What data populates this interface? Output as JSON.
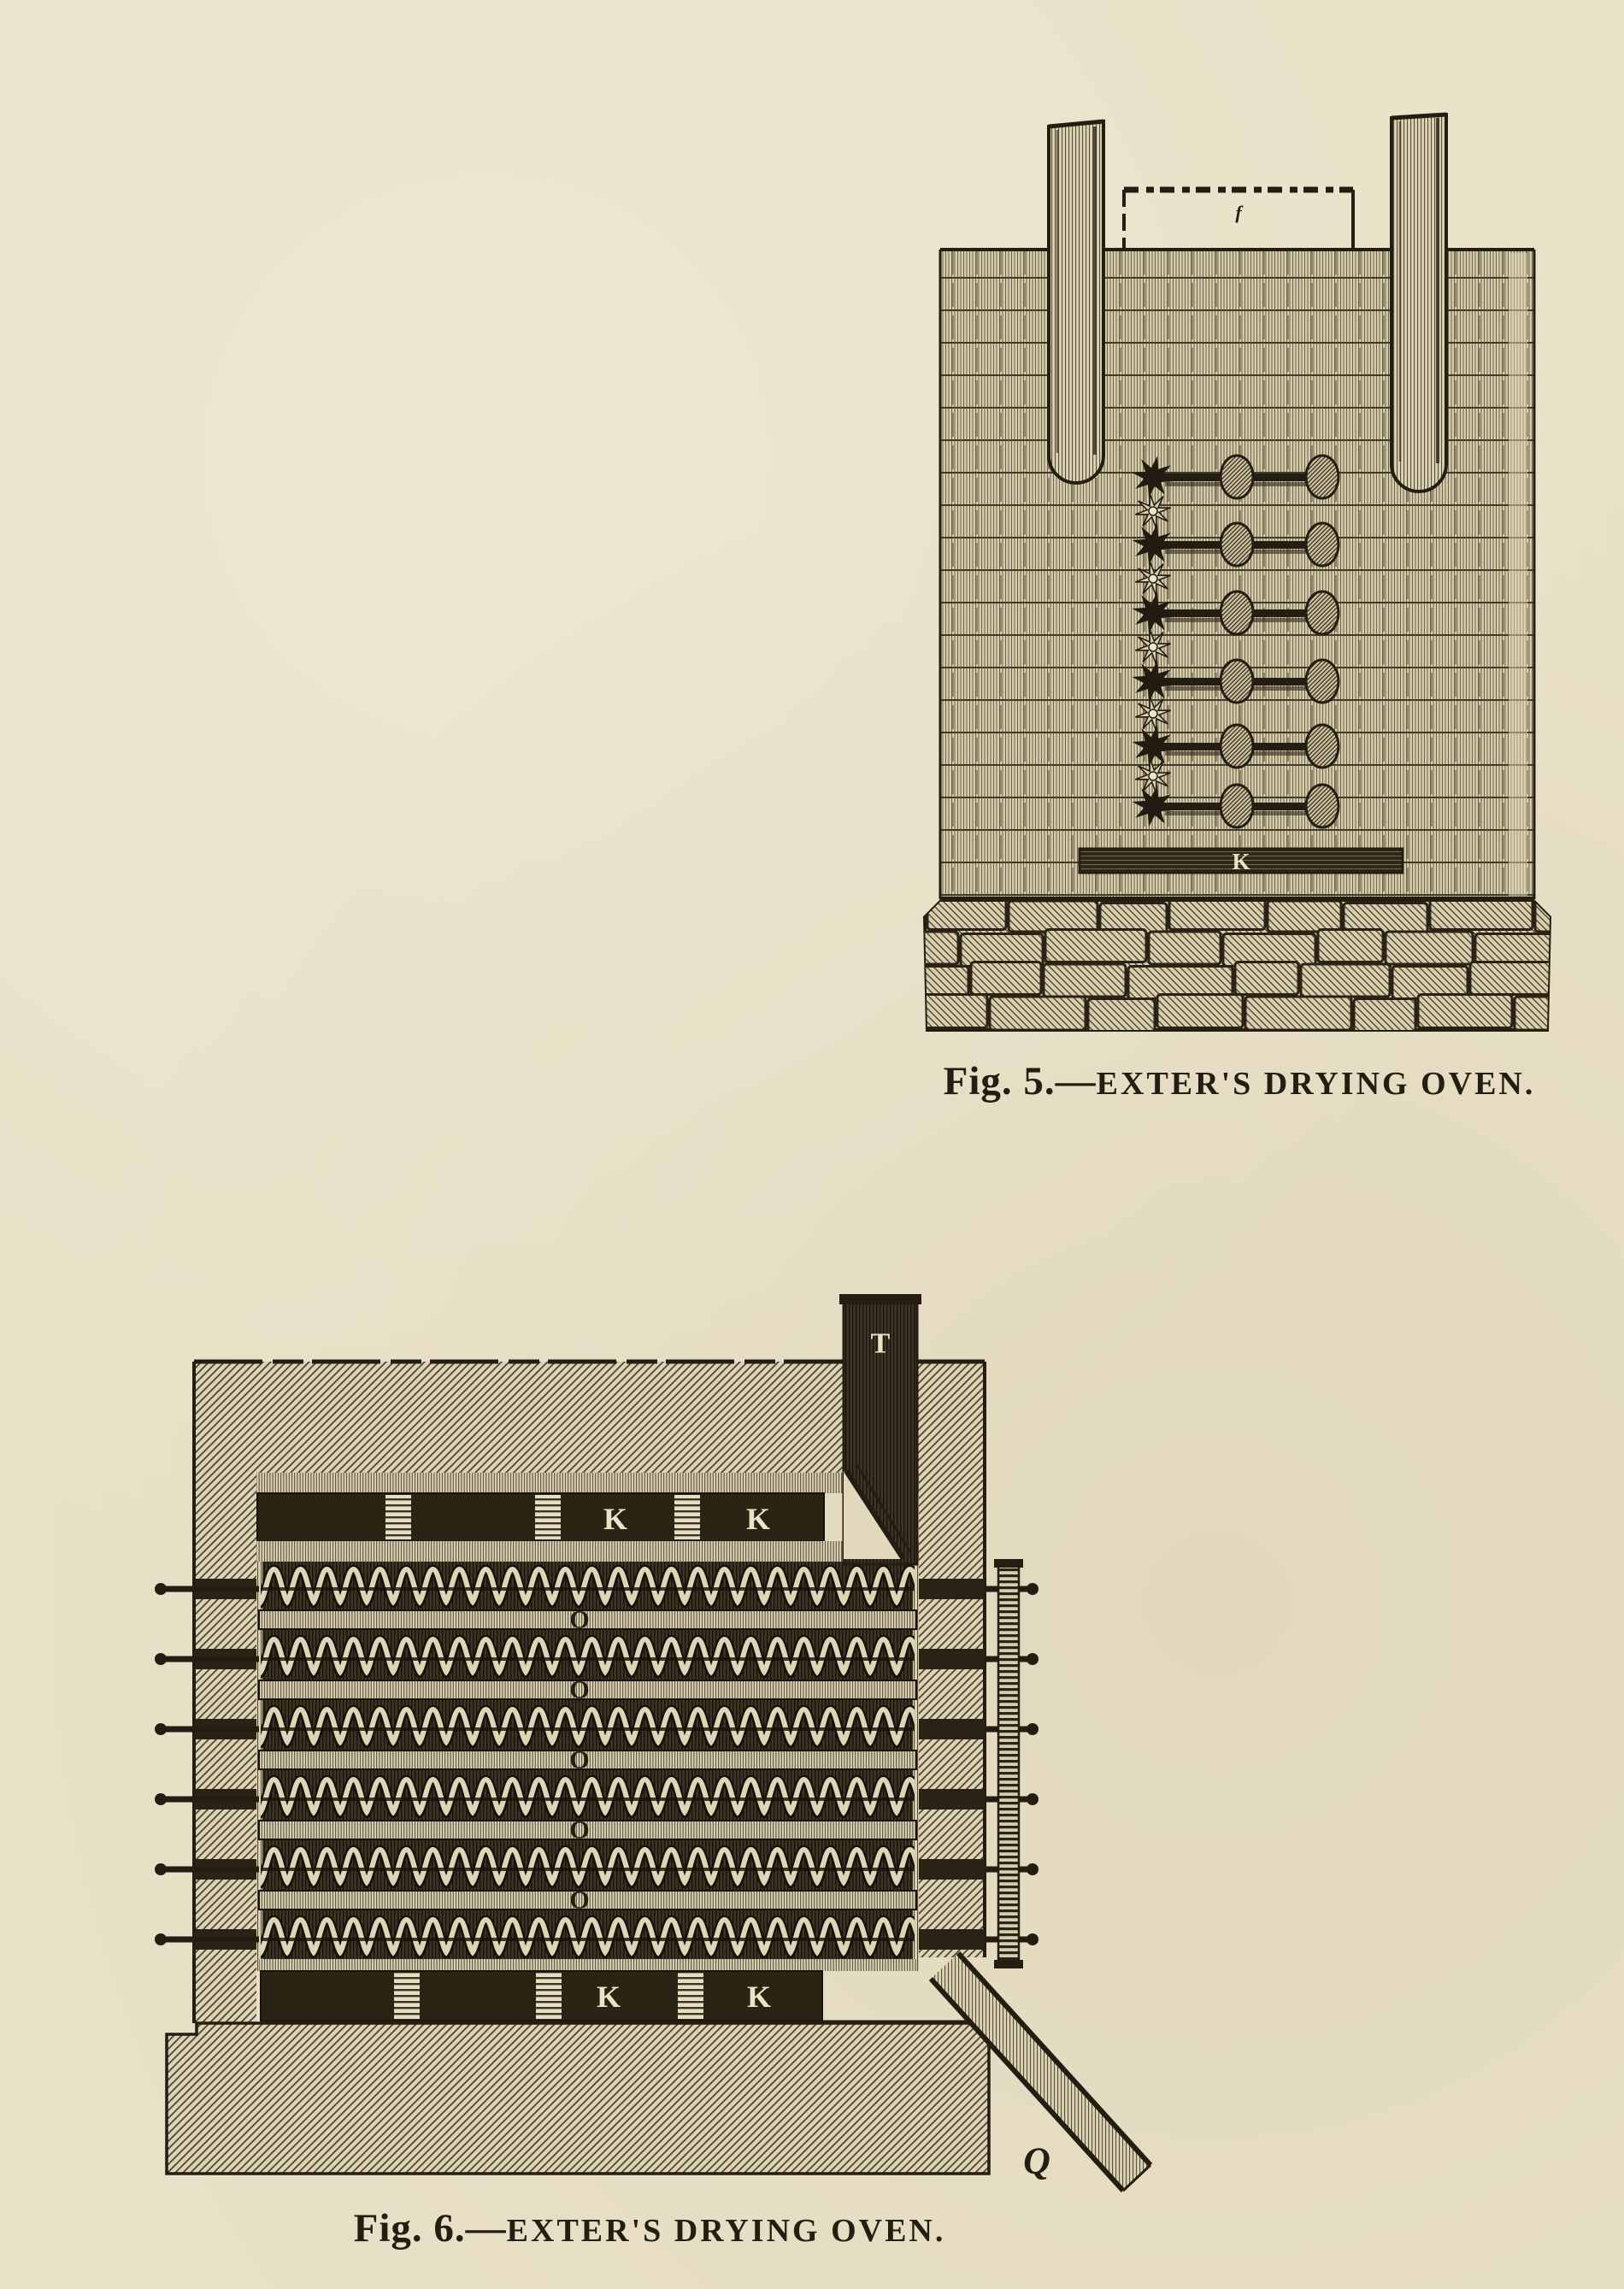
{
  "page": {
    "paper_color": "#e9e1c7",
    "ink_color": "#241d12"
  },
  "figure5": {
    "caption_prefix": "Fig. 5.—",
    "caption_title": "EXTER'S DRYING OVEN.",
    "labels": {
      "grate_bar": "K",
      "damper_mark": "f"
    }
  },
  "figure6": {
    "caption_prefix": "Fig. 6.—",
    "caption_title": "EXTER'S DRYING OVEN.",
    "labels": {
      "chimney": "T",
      "top_flue_ks": [
        "K",
        "K"
      ],
      "bottom_flue_ks": [
        "K",
        "K"
      ],
      "tray_openings": [
        "O",
        "O",
        "O",
        "O",
        "O"
      ],
      "chute": "Q"
    }
  }
}
